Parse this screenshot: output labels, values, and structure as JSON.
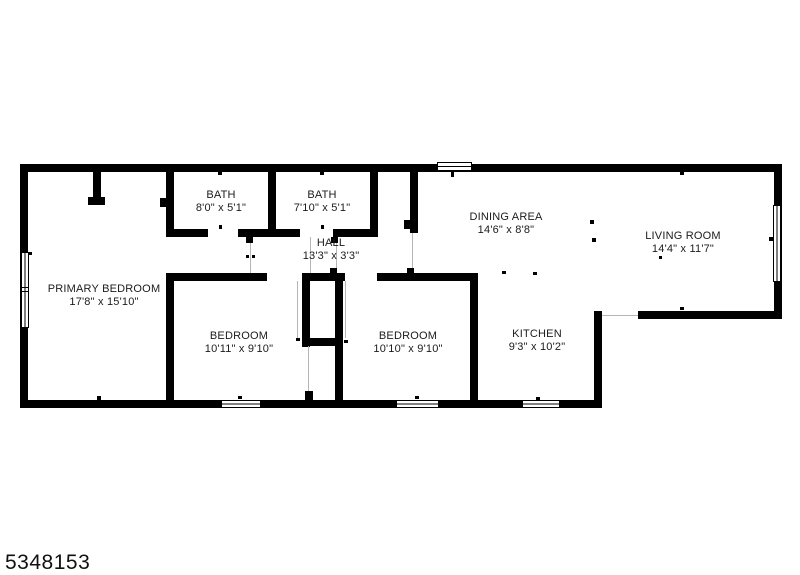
{
  "page": {
    "background": "#ffffff",
    "wall_color": "#000000",
    "opening_line_color": "#b5b5b5"
  },
  "floorplan": {
    "rooms": [
      {
        "id": "primary-bedroom",
        "name": "PRIMARY BEDROOM",
        "dims": "17'8\" x 15'10\""
      },
      {
        "id": "bath-1",
        "name": "BATH",
        "dims": "8'0\" x 5'1\""
      },
      {
        "id": "bath-2",
        "name": "BATH",
        "dims": "7'10\" x 5'1\""
      },
      {
        "id": "hall",
        "name": "HALL",
        "dims": "13'3\" x 3'3\""
      },
      {
        "id": "dining-area",
        "name": "DINING AREA",
        "dims": "14'6\" x 8'8\""
      },
      {
        "id": "living-room",
        "name": "LIVING ROOM",
        "dims": "14'4\" x 11'7\""
      },
      {
        "id": "bedroom-left",
        "name": "BEDROOM",
        "dims": "10'11\" x 9'10\""
      },
      {
        "id": "bedroom-right",
        "name": "BEDROOM",
        "dims": "10'10\" x 9'10\""
      },
      {
        "id": "kitchen",
        "name": "KITCHEN",
        "dims": "9'3\" x 10'2\""
      }
    ]
  },
  "footer": {
    "listing_number": "5348153"
  }
}
